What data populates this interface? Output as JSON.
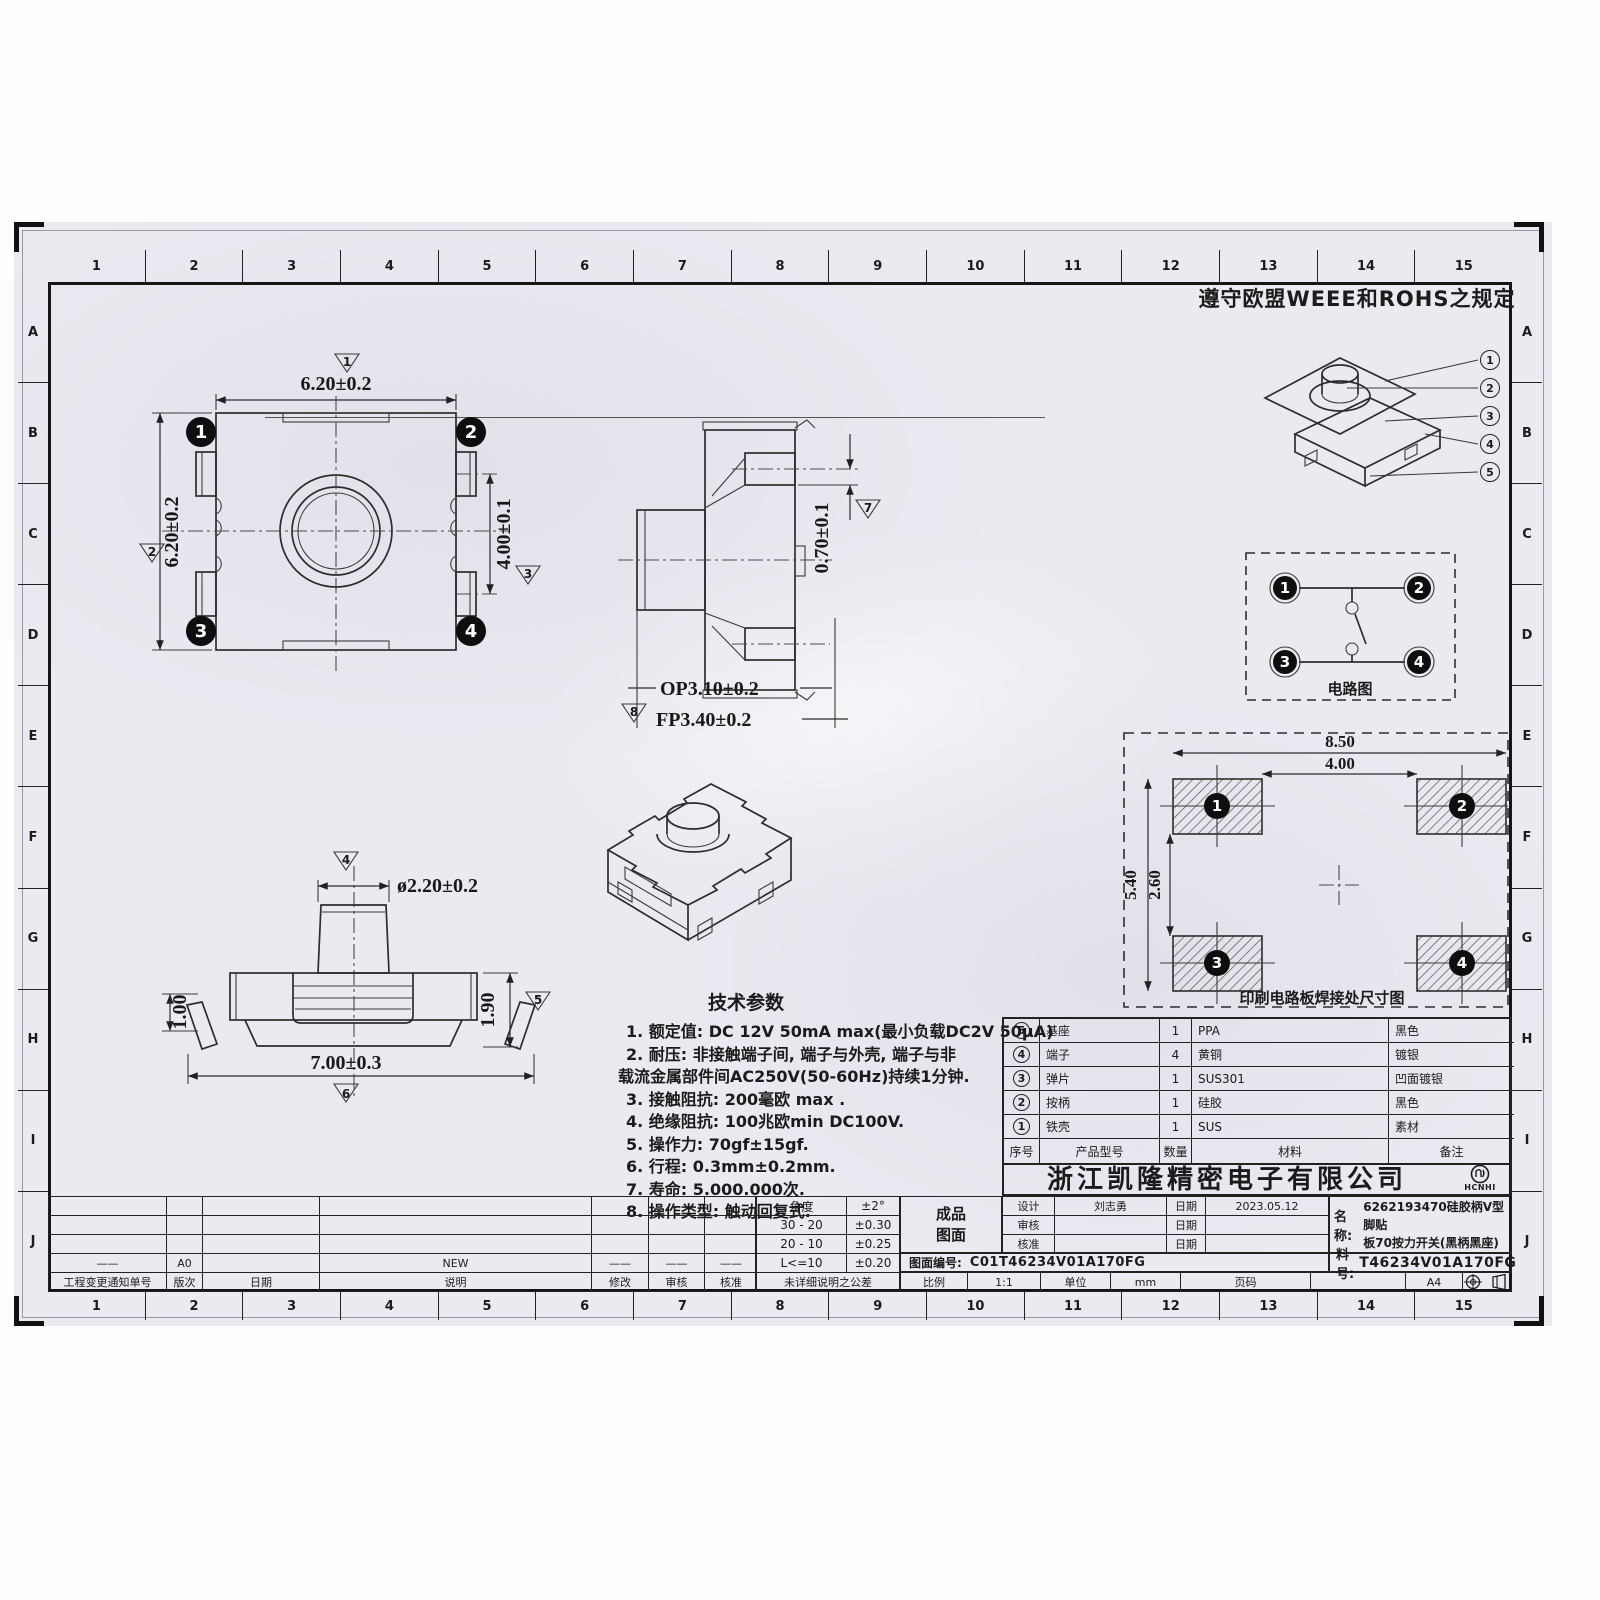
{
  "sheet": {
    "compliance_note": "遵守欧盟WEEE和ROHS之规定",
    "ruler": {
      "cols": [
        "1",
        "2",
        "3",
        "4",
        "5",
        "6",
        "7",
        "8",
        "9",
        "10",
        "11",
        "12",
        "13",
        "14",
        "15"
      ],
      "rows": [
        "A",
        "B",
        "C",
        "D",
        "E",
        "F",
        "G",
        "H",
        "I",
        "J"
      ]
    }
  },
  "views": {
    "top_view": {
      "dim_width": "6.20±0.2",
      "dim_height": "6.20±0.2",
      "dim_pin_span": "4.00±0.1",
      "pins": [
        "1",
        "2",
        "3",
        "4"
      ],
      "flags": [
        "1",
        "2",
        "3"
      ]
    },
    "side_view": {
      "dim_terminal": "0.70±0.1",
      "dim_op": "OP3.10±0.2",
      "dim_fp": "FP3.40±0.2",
      "flags": [
        "7",
        "8"
      ]
    },
    "front_view": {
      "dim_button": "ø2.20±0.2",
      "dim_lead": "1.00",
      "dim_body": "1.90",
      "dim_width": "7.00±0.3",
      "flags": [
        "4",
        "5",
        "6"
      ]
    },
    "exploded_view": {
      "callouts": [
        "1",
        "2",
        "3",
        "4",
        "5"
      ]
    },
    "circuit": {
      "title": "电路图",
      "pins": [
        "1",
        "2",
        "3",
        "4"
      ]
    },
    "pcb": {
      "title": "印刷电路板焊接处尺寸图",
      "dim_outer_w": "8.50",
      "dim_inner_w": "4.00",
      "dim_outer_h": "5.40",
      "dim_inner_h": "2.60",
      "pads": [
        "1",
        "2",
        "3",
        "4"
      ]
    }
  },
  "tech_params": {
    "title": "技术参数",
    "lines": [
      "1. 额定值: DC 12V 50mA max(最小负载DC2V 50μA)",
      "2. 耐压: 非接触端子间, 端子与外壳, 端子与非",
      "载流金属部件间AC250V(50-60Hz)持续1分钟.",
      "3. 接触阻抗: 200毫欧 max .",
      "4. 绝缘阻抗: 100兆欧min DC100V.",
      "5. 操作力: 70gf±15gf.",
      "6. 行程: 0.3mm±0.2mm.",
      "7. 寿命: 5.000.000次.",
      "8. 操作类型: 触动回复式."
    ]
  },
  "bom": {
    "headers": {
      "no": "序号",
      "model": "产品型号",
      "qty": "数量",
      "material": "材料",
      "remark": "备注"
    },
    "rows": [
      {
        "no": "5",
        "name": "基座",
        "qty": "1",
        "material": "PPA",
        "remark": "黑色"
      },
      {
        "no": "4",
        "name": "端子",
        "qty": "4",
        "material": "黄铜",
        "remark": "镀银"
      },
      {
        "no": "3",
        "name": "弹片",
        "qty": "1",
        "material": "SUS301",
        "remark": "凹面镀银"
      },
      {
        "no": "2",
        "name": "按柄",
        "qty": "1",
        "material": "硅胶",
        "remark": "黑色"
      },
      {
        "no": "1",
        "name": "铁壳",
        "qty": "1",
        "material": "SUS",
        "remark": "素材"
      }
    ]
  },
  "company": {
    "name": "浙江凯隆精密电子有限公司",
    "logo_text": "HCNHI"
  },
  "title_block": {
    "design_label": "设计",
    "designer": "刘志勇",
    "date_label": "日期",
    "design_date": "2023.05.12",
    "review_label": "审核",
    "approve_label": "核准",
    "name_label": "名称:",
    "name_line1": "6262193470硅胶柄V型脚贴",
    "name_line2": "板70按力开关(黑柄黑座)",
    "part_label": "料号:",
    "part_no": "T46234V01A170FG",
    "drawing_no_label": "图面编号:",
    "drawing_no": "C01T46234V01A170FG",
    "product_line1": "成品",
    "product_line2": "图面",
    "scale_label": "比例",
    "scale": "1:1",
    "unit_label": "单位",
    "unit": "mm",
    "page_label": "页码",
    "paper_size": "A4"
  },
  "tolerance_table": {
    "rows": [
      [
        "角度",
        "±2°"
      ],
      [
        "30 - 20",
        "±0.30"
      ],
      [
        "20 - 10",
        "±0.25"
      ],
      [
        "L<=10",
        "±0.20"
      ]
    ],
    "footer": "未详细说明之公差"
  },
  "revision_table": {
    "headers": [
      "工程变更通知单号",
      "版次",
      "日期",
      "说明",
      "修改",
      "审核",
      "核准"
    ],
    "row": [
      "——",
      "A0",
      "",
      "NEW",
      "——",
      "——",
      "——"
    ]
  }
}
